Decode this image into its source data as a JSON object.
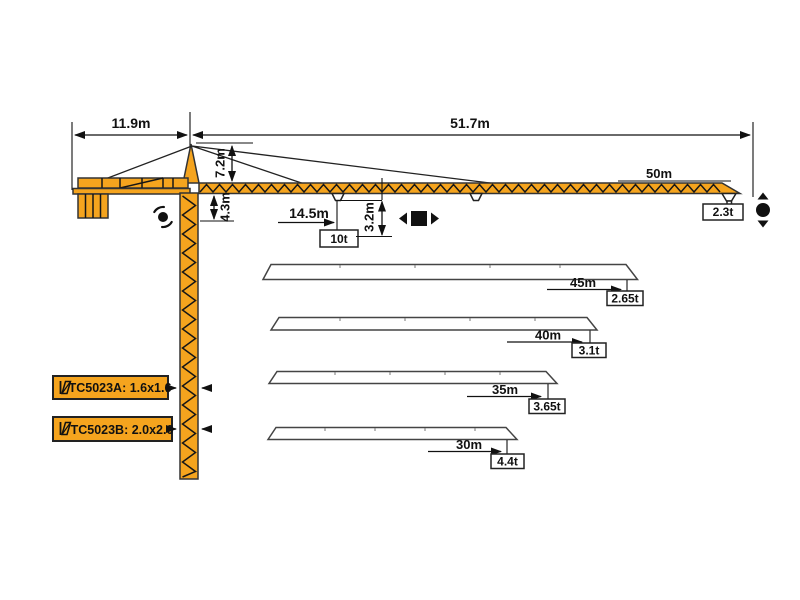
{
  "colors": {
    "crane_orange": "#F5A41E",
    "outline": "#333333",
    "line": "#111111",
    "box_background": "#ffffff"
  },
  "dimensions": {
    "counter_jib_length": "11.9m",
    "main_jib_length": "51.7m",
    "head_height": "7.2m",
    "under_jib_height": "4.3m",
    "trolley_radius": "14.5m",
    "trolley_load": "10t",
    "hook_height": "3.2m",
    "tip_radius": "50m",
    "tip_load": "2.3t"
  },
  "jib_variants": [
    {
      "length": "45m",
      "tip_load": "2.65t"
    },
    {
      "length": "40m",
      "tip_load": "3.1t"
    },
    {
      "length": "35m",
      "tip_load": "3.65t"
    },
    {
      "length": "30m",
      "tip_load": "4.4t"
    }
  ],
  "models": [
    {
      "label": "TC5023A: 1.6x1.6"
    },
    {
      "label": "TC5023B: 2.0x2.0"
    }
  ],
  "icons": {
    "slewing": "slewing-icon",
    "trolley_travel": "trolley-travel-icon",
    "hoist": "hoist-icon",
    "mast_section": "mast-section-icon"
  }
}
